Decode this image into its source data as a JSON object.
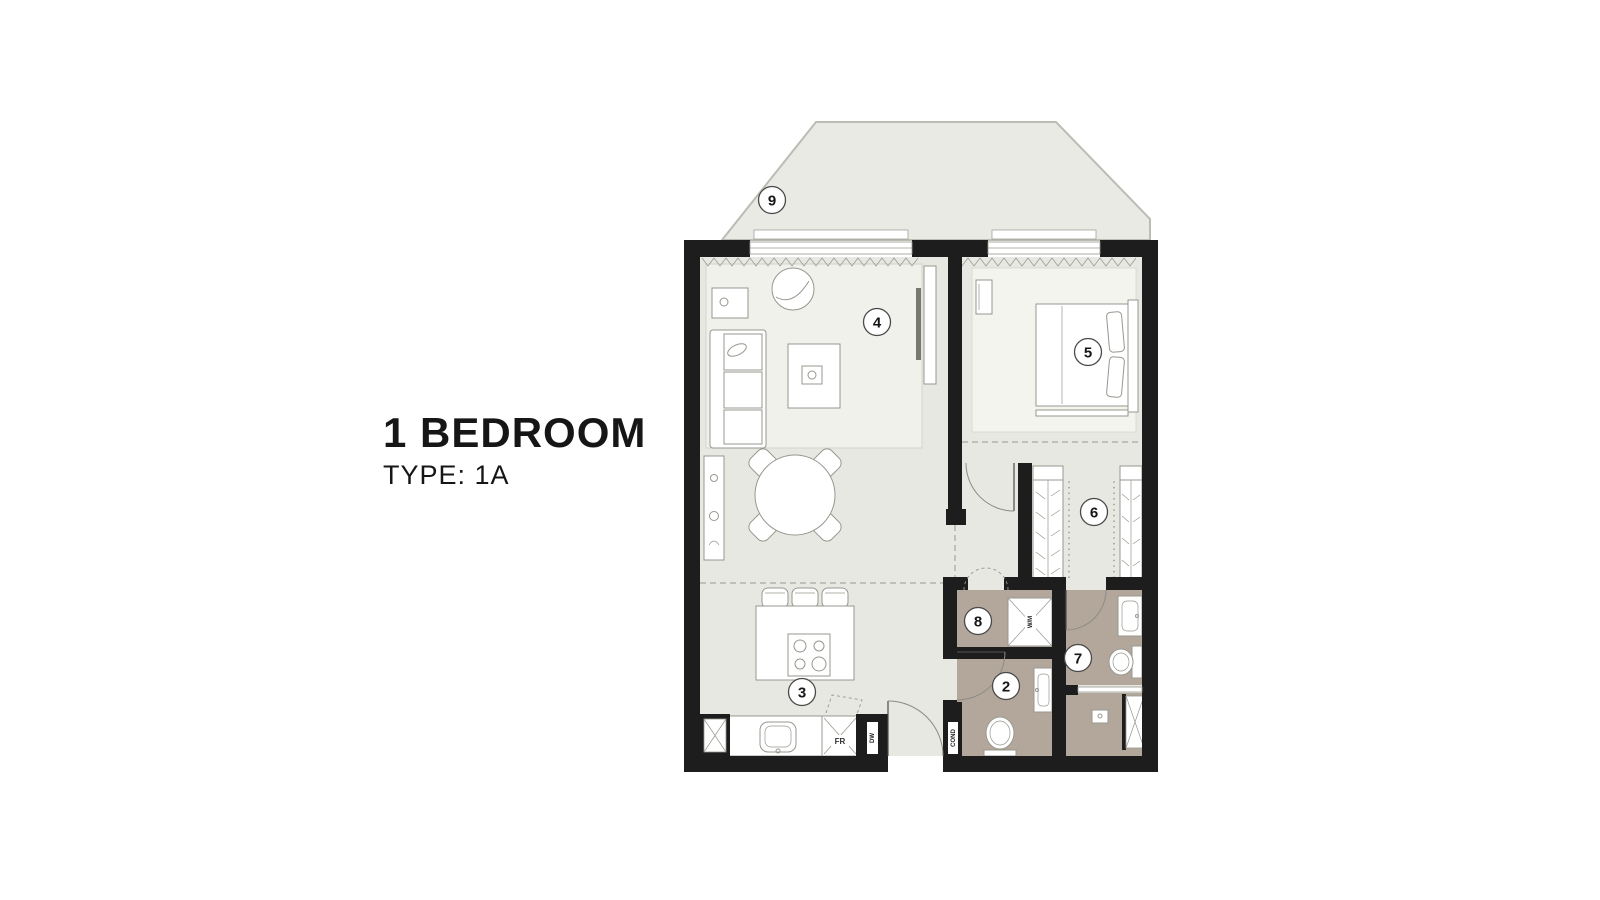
{
  "title": {
    "heading": "1 BEDROOM",
    "subheading": "TYPE: 1A"
  },
  "floorplan": {
    "room_labels": {
      "balcony": "9",
      "living_dining": "4",
      "bedroom": "5",
      "wardrobe": "6",
      "bathroom": "7",
      "laundry": "8",
      "powder_room": "2",
      "kitchen": "3"
    },
    "appliance_labels": {
      "fridge": "FR",
      "washing_machine": "W/M",
      "dishwasher": "DW",
      "condenser": "COND"
    },
    "colors": {
      "wall": "#1d1d1d",
      "floor": "#e8e8e2",
      "wet_floor": "#b3a79b",
      "balcony_floor": "#eaeae4",
      "outline": "#97978f",
      "text": "#161616"
    }
  }
}
